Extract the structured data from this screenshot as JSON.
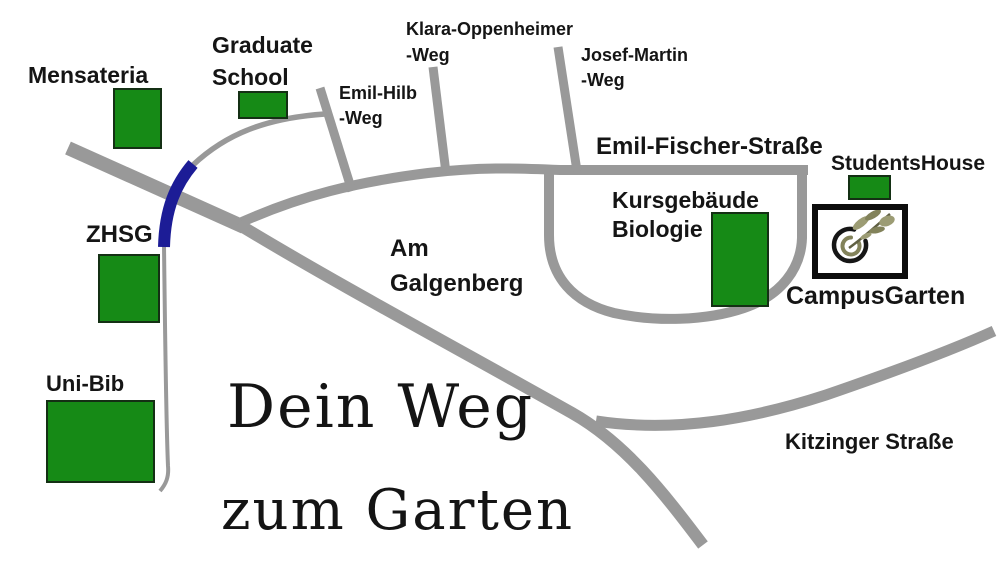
{
  "map_title": {
    "line1": "Dein Weg",
    "line2": "zum Garten"
  },
  "buildings": {
    "mensateria": {
      "label": "Mensateria"
    },
    "graduate_school": {
      "line1": "Graduate",
      "line2": "School"
    },
    "zhsg": {
      "label": "ZHSG"
    },
    "uni_bib": {
      "label": "Uni-Bib"
    },
    "kursgebaeude_biologie": {
      "line1": "Kursgebäude",
      "line2": "Biologie"
    },
    "students_house": {
      "label": "StudentsHouse"
    }
  },
  "destination": {
    "label": "CampusGarten",
    "icon": "leaf-circle-logo-icon"
  },
  "streets": {
    "klara_oppenheimer": {
      "line1": "Klara-Oppenheimer",
      "line2": "-Weg"
    },
    "emil_hilb": {
      "line1": "Emil-Hilb",
      "line2": "-Weg"
    },
    "josef_martin": {
      "line1": "Josef-Martin",
      "line2": "-Weg"
    },
    "emil_fischer": {
      "label": "Emil-Fischer-Straße"
    },
    "am_galgenberg": {
      "line1": "Am",
      "line2": "Galgenberg"
    },
    "kitzinger": {
      "label": "Kitzinger Straße"
    }
  },
  "colors": {
    "building_green": "#168a16",
    "road_gray": "#999999",
    "route_blue": "#1c1c96",
    "logo_olive": "#9c9c74",
    "logo_olive_dark": "#82825a"
  }
}
